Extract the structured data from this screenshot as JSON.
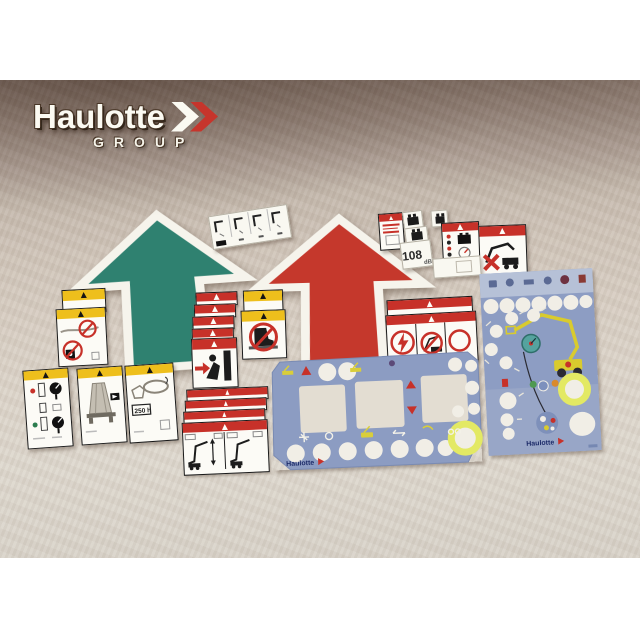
{
  "logo": {
    "brand": "Haulotte",
    "group": "GROUP"
  },
  "arrows": {
    "green": {
      "name": "green-direction-arrow",
      "color": "#2f8170"
    },
    "red": {
      "name": "red-direction-arrow",
      "color": "#c5382c"
    }
  },
  "stickers": {
    "noise_level": {
      "value": "108",
      "unit": "dB"
    },
    "service_interval": {
      "label": "250 h"
    },
    "list": [
      "harness-instruction-sticker",
      "notice-text-sticker",
      "battery-charge-stickers",
      "noise-level-sticker",
      "battery-check-sticker",
      "no-boom-operation-sticker",
      "blank-rectangle-sticker",
      "no-wash-anchor-warning-label",
      "gauge-instruction-label",
      "platform-load-label",
      "service-250h-label",
      "crush-hazard-label-stack",
      "no-step-label-pair",
      "boom-outreach-label-stack",
      "electrocution-tipping-warning-labels"
    ]
  },
  "panels": {
    "wide": {
      "name": "ground-control-panel-overlay",
      "brand": "Haulotte"
    },
    "tall": {
      "name": "platform-control-panel-overlay",
      "brand": "Haulotte"
    }
  },
  "colors": {
    "cloth_top": "#87766d",
    "cloth_bottom": "#ddd7cd",
    "band_yellow": "#eebf1c",
    "band_red": "#c73129",
    "panel_blue": "#8c9cc2",
    "panel_strip": "#b6c1d7",
    "ring_yellow": "#e3e964",
    "logo_red": "#c6352c",
    "arrow_green": "#2f8170",
    "arrow_red": "#c5382c"
  }
}
